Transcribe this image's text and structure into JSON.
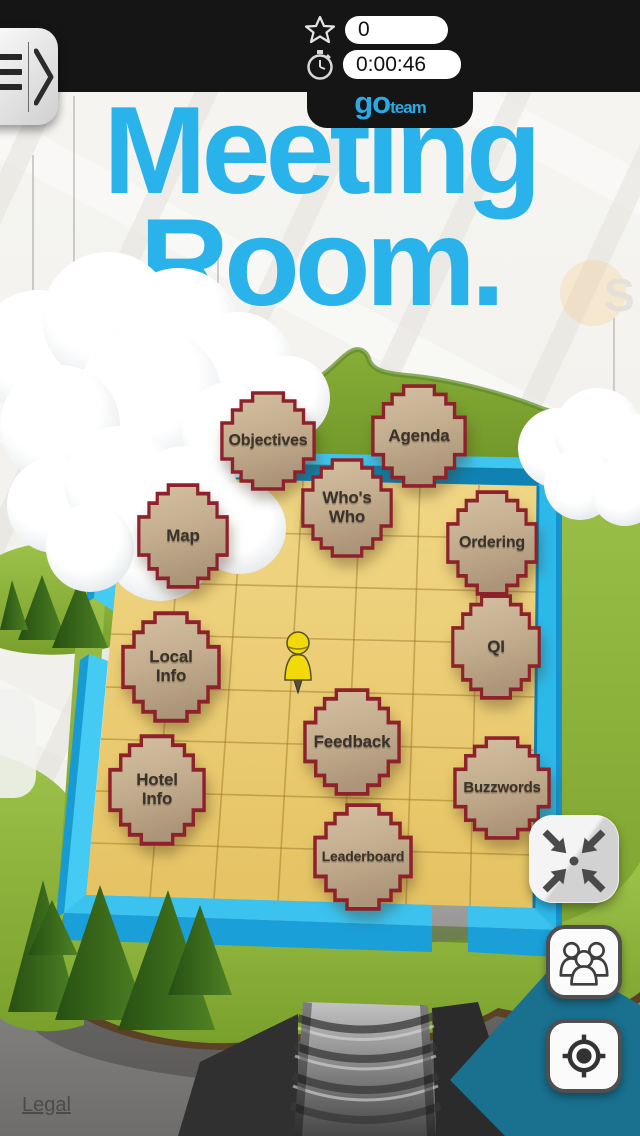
{
  "status_bar": {
    "score": "0",
    "timer": "0:00:46"
  },
  "logo": {
    "part1": "go",
    "part2": "team"
  },
  "title": {
    "line1": "Meeting",
    "line2": "Room."
  },
  "board": {
    "tiles": [
      {
        "id": "objectives",
        "label": "Objectives"
      },
      {
        "id": "agenda",
        "label": "Agenda"
      },
      {
        "id": "whos-who",
        "label": "Who's\nWho"
      },
      {
        "id": "map",
        "label": "Map"
      },
      {
        "id": "ordering",
        "label": "Ordering"
      },
      {
        "id": "local-info",
        "label": "Local\nInfo"
      },
      {
        "id": "qi",
        "label": "QI"
      },
      {
        "id": "feedback",
        "label": "Feedback"
      },
      {
        "id": "hotel-info",
        "label": "Hotel\nInfo"
      },
      {
        "id": "buzzwords",
        "label": "Buzzwords"
      },
      {
        "id": "leaderboard",
        "label": "Leaderboard"
      }
    ]
  },
  "watermark": {
    "letter": "S"
  },
  "footer": {
    "legal": "Legal"
  },
  "icons": {
    "score": "star-outline-icon",
    "timer": "stopwatch-icon",
    "menu": "hamburger-chevron-icon",
    "fit": "collapse-arrows-icon",
    "teams": "group-icon",
    "locate": "locate-target-icon"
  },
  "colors": {
    "accent_cyan": "#29B3EA",
    "logo_blue": "#2AA9E2",
    "topbar": "#151515",
    "tile_border": "#8E222C",
    "tile_fill": "#C2AC8D",
    "wall": "#3BC2EE",
    "floor": "#EDD079",
    "grass": "#8CB53B",
    "teal_shape": "#19708F"
  }
}
